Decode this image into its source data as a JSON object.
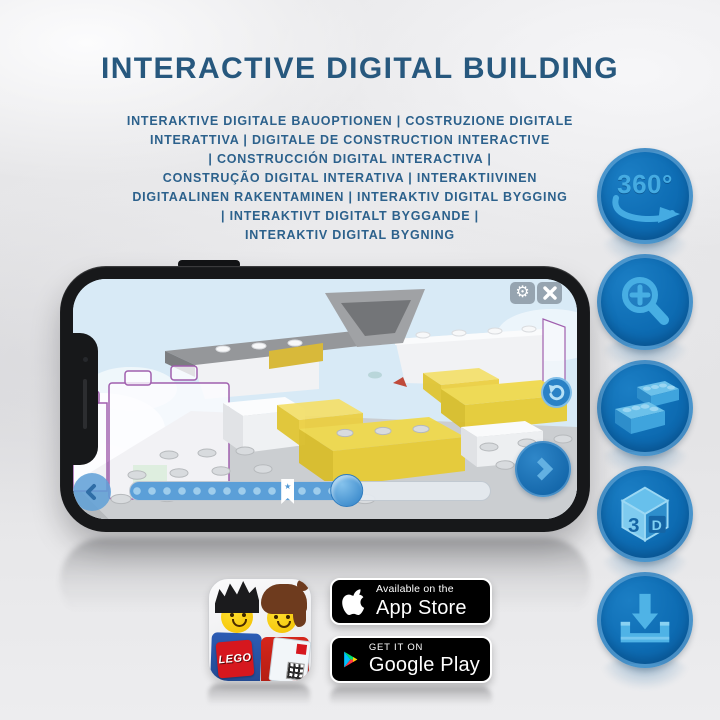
{
  "title": "INTERACTIVE DIGITAL BUILDING",
  "subtitle_lines": [
    "INTERAKTIVE DIGITALE BAUOPTIONEN | COSTRUZIONE DIGITALE",
    "INTERATTIVA | DIGITALE DE CONSTRUCTION INTERACTIVE",
    "| CONSTRUCCIÓN DIGITAL INTERACTIVA |",
    "CONSTRUÇÃO DIGITAL INTERATIVA | INTERAKTIIVINEN",
    "DIGITAALINEN RAKENTAMINEN | INTERAKTIV DIGITAL BYGGING",
    "| INTERAKTIVT DIGITALT BYGGANDE |",
    "INTERAKTIV DIGITAL BYGNING"
  ],
  "features": {
    "rotate_360_label": "360°",
    "cube_left_label": "3",
    "cube_right_label": "D"
  },
  "phone": {
    "ui": {
      "gear_glyph": "⚙",
      "bookmark_star": "★"
    },
    "slider": {
      "progress_percent": 61,
      "bookmark_percent": 42
    }
  },
  "badges": {
    "app_store": {
      "tagline": "Available on the",
      "store": "App Store"
    },
    "google_play": {
      "tagline": "GET IT ON",
      "store": "Google Play"
    },
    "lego_logo_text": "LEGO"
  },
  "colors": {
    "title_blue": "#27587e",
    "subtitle_blue": "#2c618c",
    "feature_circle_blue": "#0e6db4",
    "feature_glyph_blue": "#47aee3",
    "bed_yellow": "#f0d94a",
    "sky_blue": "#d8eaf6"
  }
}
